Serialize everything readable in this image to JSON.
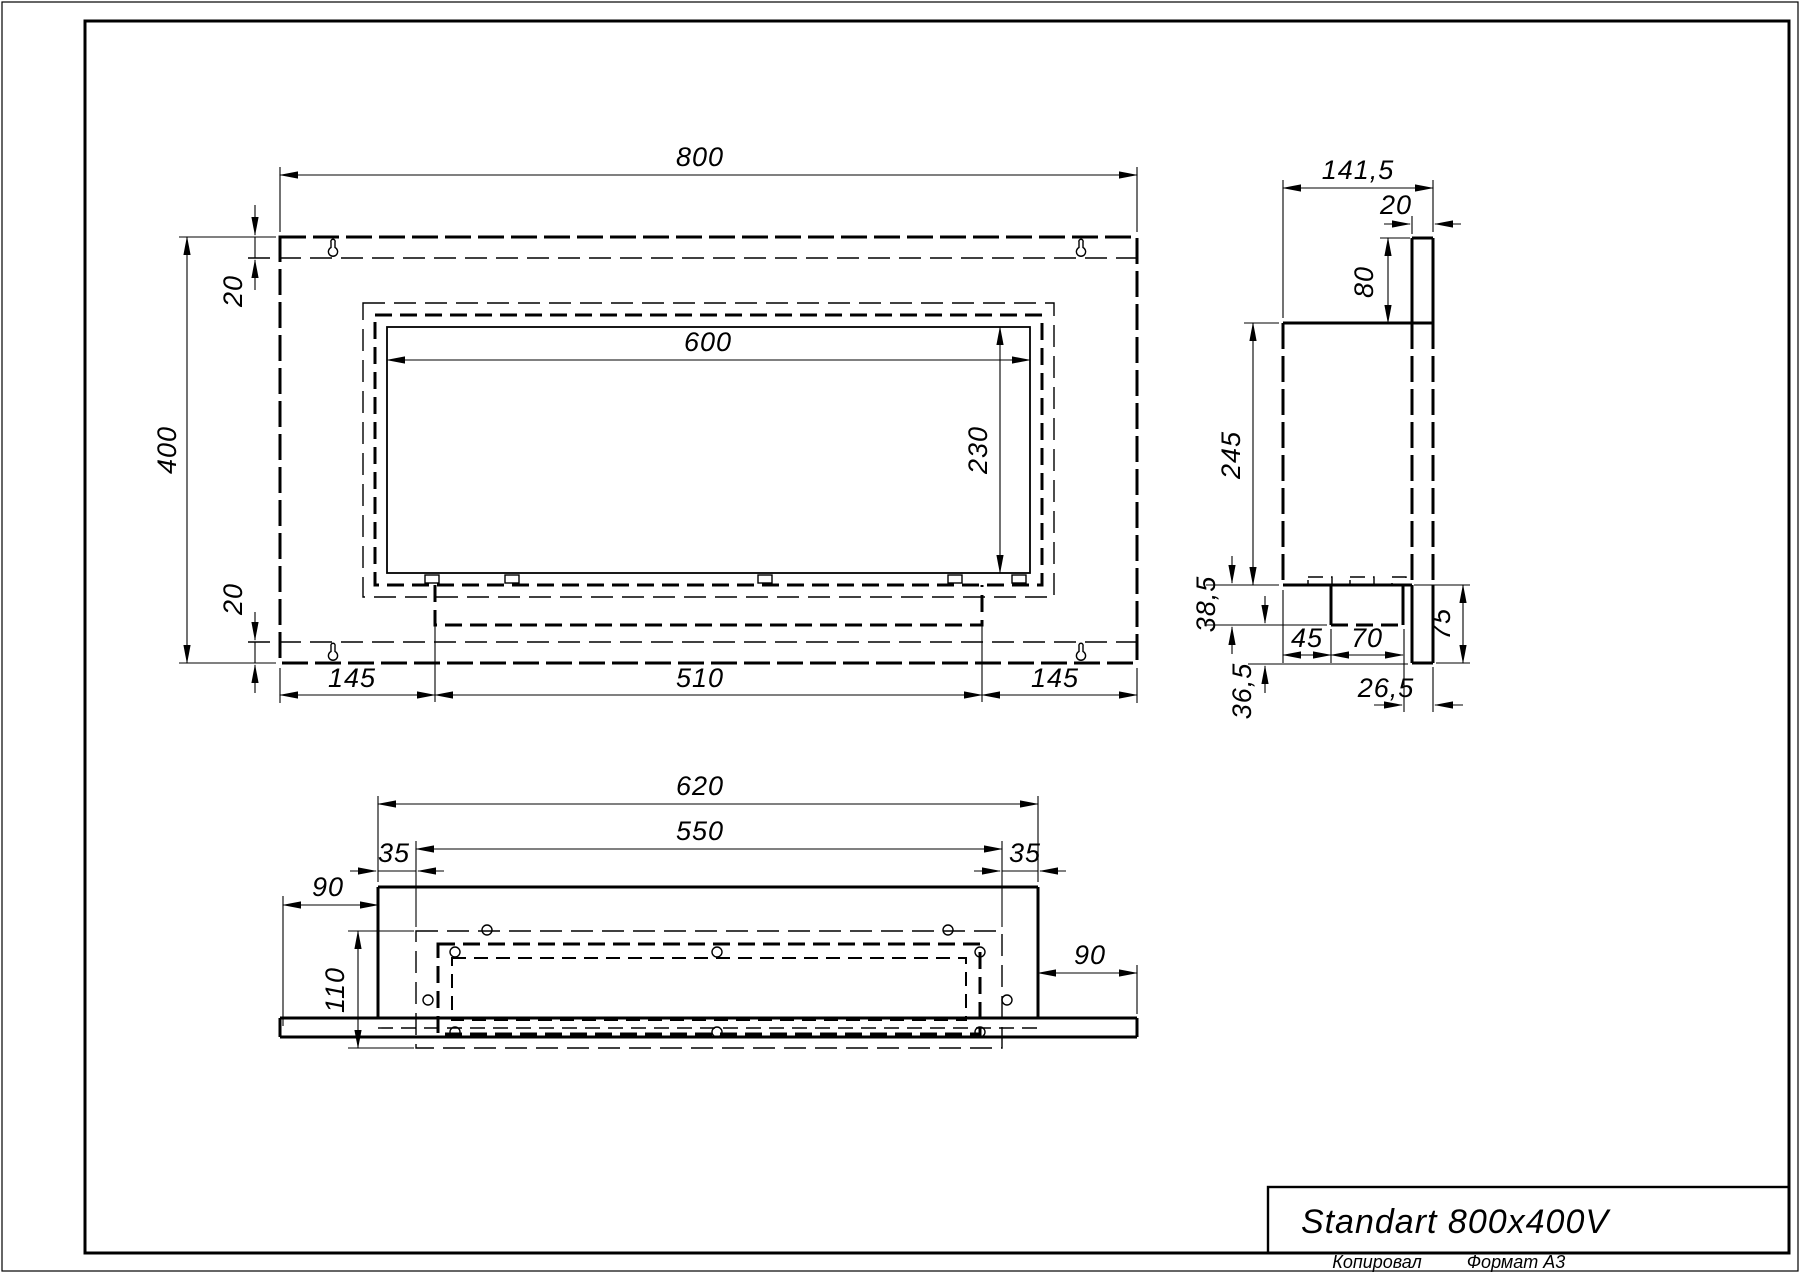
{
  "views": {
    "front": {
      "overall_width": "800",
      "overall_height": "400",
      "top_inset": "20",
      "bottom_inset": "20",
      "opening_width": "600",
      "opening_height": "230",
      "tray_left": "145",
      "tray_width": "510",
      "tray_right": "145"
    },
    "side": {
      "depth": "141,5",
      "panel_thickness": "20",
      "hanger_height": "80",
      "body_height": "245",
      "burner_offset": "45",
      "burner_width": "70",
      "burner_depth": "38,5",
      "bottom_clearance": "36,5",
      "back_offset": "26,5",
      "panel_drop": "75"
    },
    "bottom": {
      "tray_width": "620",
      "cutout_width": "550",
      "inset_left": "35",
      "inset_right": "35",
      "overhang_left": "90",
      "overhang_right": "90",
      "cutout_depth": "110"
    }
  },
  "title_block": {
    "model": "Standart 800x400V"
  },
  "footer": {
    "copied_label": "Копировал",
    "format_label": "Формат А3"
  }
}
